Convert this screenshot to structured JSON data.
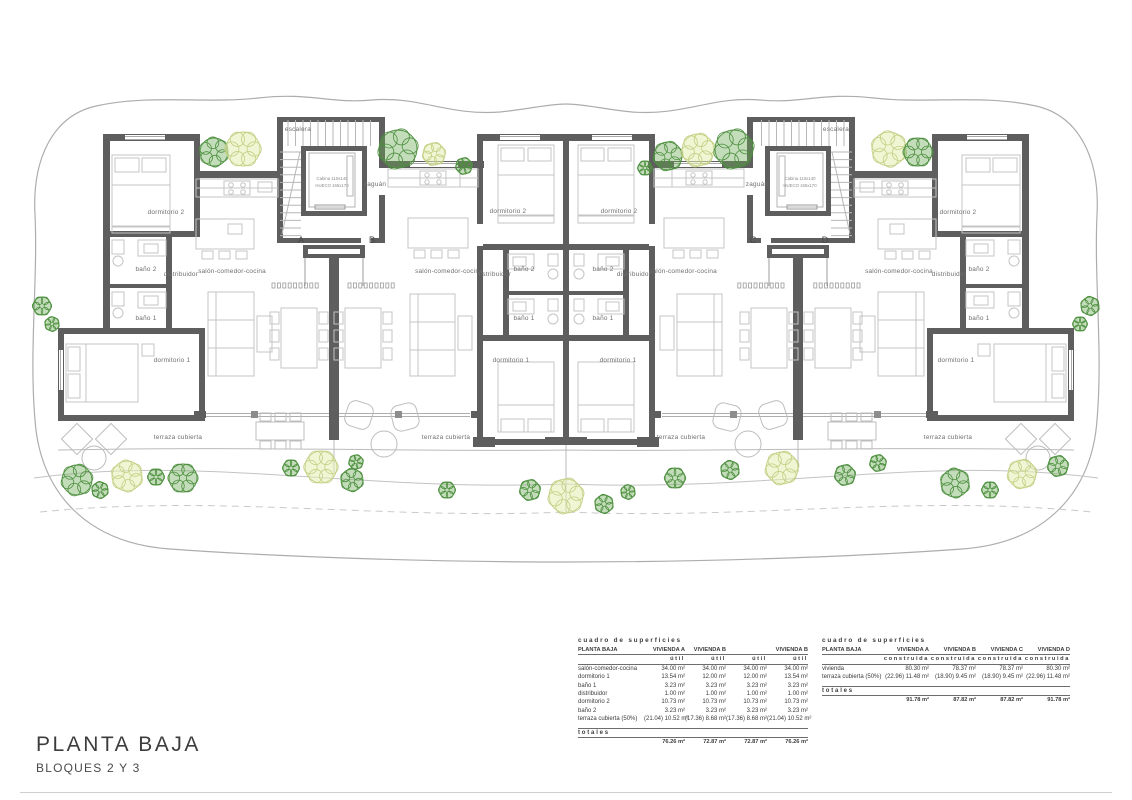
{
  "page": {
    "title": "PLANTA BAJA",
    "subtitle": "BLOQUES 2 Y 3"
  },
  "plan": {
    "rooms": {
      "dormitorio1": "dormitorio 1",
      "dormitorio2": "dormitorio 2",
      "bano1": "baño 1",
      "bano2": "baño 2",
      "distribuidor": "distribuidor",
      "salon": "salón-comedor-cocina",
      "terraza": "terraza cubierta",
      "escalera": "escalera",
      "zaguan": "zaguán"
    },
    "elevator": {
      "line1": "Cabina 110x140",
      "line2": "HUECO 165x170"
    },
    "sections": {
      "a": "A",
      "b": "B",
      "c": "C",
      "d": "D"
    }
  },
  "tables": {
    "util": {
      "title": "cuadro de superficies",
      "row_header": "PLANTA BAJA",
      "columns": [
        "VIVIENDA A",
        "VIVIENDA B",
        "",
        "VIVIENDA B"
      ],
      "sub_header": "útil",
      "rows": [
        {
          "label": "salón-comedor-cocina",
          "values": [
            "34.00 m²",
            "34.00 m²",
            "34.00 m²",
            "34.00 m²"
          ]
        },
        {
          "label": "dormitorio 1",
          "values": [
            "13.54 m²",
            "12.00 m²",
            "12.00 m²",
            "13.54 m²"
          ]
        },
        {
          "label": "baño 1",
          "values": [
            "3.23 m²",
            "3.23 m²",
            "3.23 m²",
            "3.23 m²"
          ]
        },
        {
          "label": "distribuidor",
          "values": [
            "1.00 m²",
            "1.00 m²",
            "1.00 m²",
            "1.00 m²"
          ]
        },
        {
          "label": "dormitorio 2",
          "values": [
            "10.73 m²",
            "10.73 m²",
            "10.73 m²",
            "10.73 m²"
          ]
        },
        {
          "label": "baño 2",
          "values": [
            "3.23 m²",
            "3.23 m²",
            "3.23 m²",
            "3.23 m²"
          ]
        },
        {
          "label": "terraza cubierta (50%)",
          "values": [
            "(21.04) 10.52 m²",
            "(17.36) 8.68 m²",
            "(17.36) 8.68 m²",
            "(21.04) 10.52 m²"
          ]
        }
      ],
      "totals_label": "totales",
      "totals": [
        "76.26 m²",
        "72.87 m²",
        "72.87 m²",
        "76.26 m²"
      ]
    },
    "construida": {
      "title": "cuadro de superficies",
      "row_header": "PLANTA BAJA",
      "columns": [
        "VIVIENDA A",
        "VIVIENDA B",
        "VIVIENDA C",
        "VIVIENDA D"
      ],
      "sub_header": "construida",
      "rows": [
        {
          "label": "vivienda",
          "values": [
            "80.30 m²",
            "78.37 m²",
            "78.37 m²",
            "80.30 m²"
          ]
        },
        {
          "label": "terraza cubierta (50%)",
          "values": [
            "(22.96) 11.48 m²",
            "(18.90) 9.45 m²",
            "(18.90) 9.45 m²",
            "(22.96) 11.48 m²"
          ]
        }
      ],
      "totals_label": "totales",
      "totals": [
        "91.78 m²",
        "87.82 m²",
        "87.82 m²",
        "91.78 m²"
      ]
    }
  }
}
